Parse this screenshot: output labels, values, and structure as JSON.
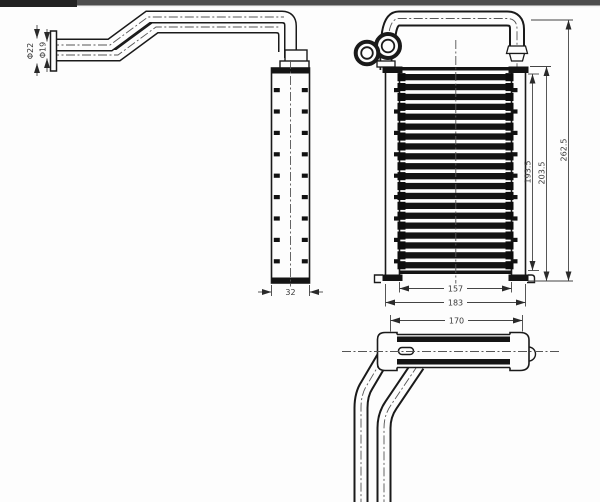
{
  "window": {
    "topbar_left_color": "#222222",
    "topbar_color": "#4d4d4d",
    "background": "#fdfdfd"
  },
  "drawing": {
    "type": "technical-orthographic-drawing",
    "part": "heater-core-with-inlet-outlet-pipes",
    "labels": {
      "pipe_outer_dia": "Φ22",
      "pipe_inner_dia": "Φ19",
      "core_depth": "32",
      "fin_height": "193.5",
      "core_height": "203.5",
      "overall_height": "262.5",
      "core_width": "157",
      "tank_width": "183",
      "top_width": "170"
    },
    "line_color": "#1a1a1a",
    "dimension_color": "#444444"
  }
}
